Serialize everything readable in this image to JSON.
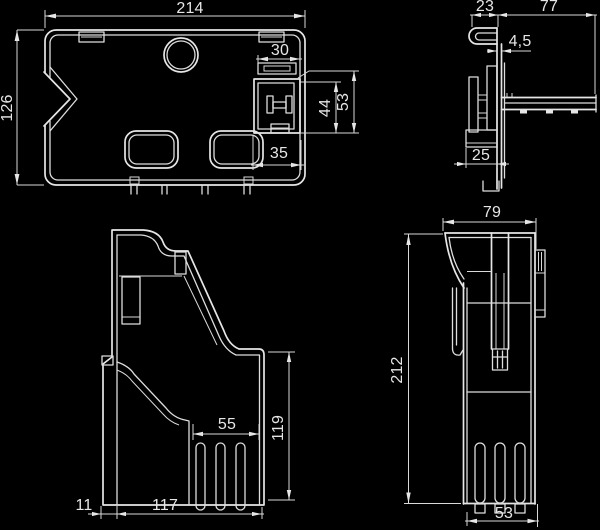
{
  "drawing": {
    "type": "technical-drawing",
    "background_color": "#000000",
    "line_color": "#e6e6e6",
    "views": {
      "plan": {
        "name": "plan-view",
        "dims": {
          "overall_width": "214",
          "overall_depth": "126",
          "valve_top_width": "30",
          "valve_height_inner": "44",
          "valve_height_outer": "53",
          "valve_bottom_width": "35"
        }
      },
      "profile": {
        "name": "profile-view",
        "dims": {
          "hook_offset": "23",
          "rail_length": "77",
          "wall_thickness": "4,5",
          "foot_width": "25"
        }
      },
      "side": {
        "name": "side-view",
        "dims": {
          "slot_field_width": "55",
          "lower_height": "119",
          "base_width": "117",
          "base_inset": "11"
        }
      },
      "front": {
        "name": "front-view",
        "dims": {
          "top_width": "79",
          "overall_height": "212",
          "bottom_width": "53"
        }
      }
    }
  }
}
